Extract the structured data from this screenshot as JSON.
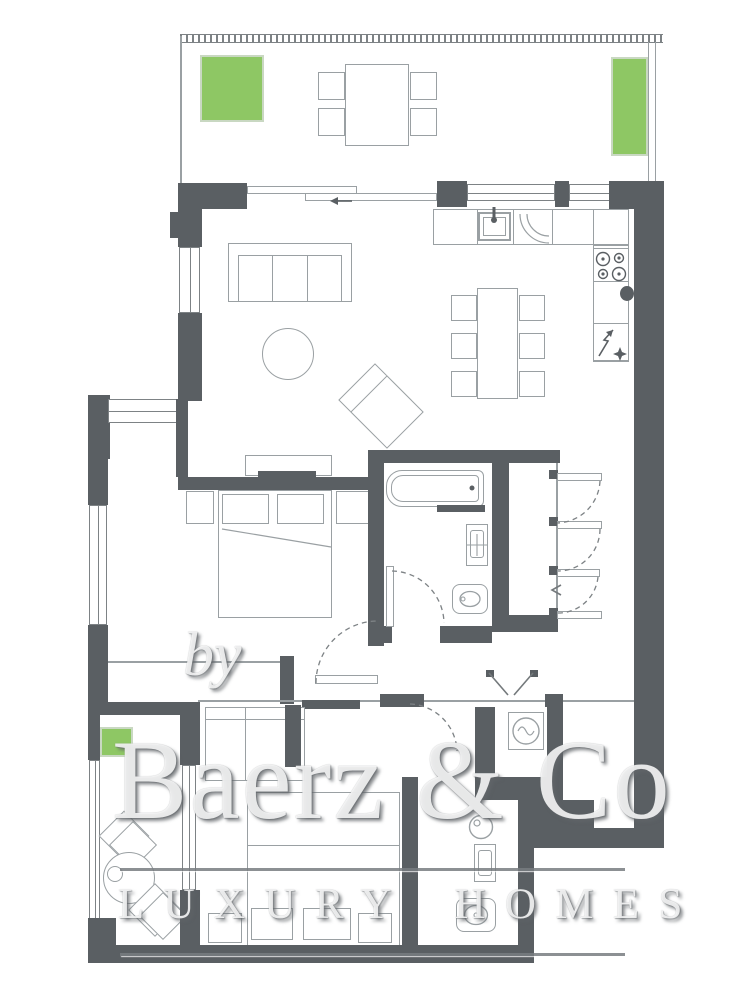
{
  "watermark": {
    "prefix": "by",
    "brand": "Baerz & Co",
    "tagline": "LUXURY HOMES"
  },
  "colors": {
    "wall": "#5a5f63",
    "furniture_line": "#9aa0a3",
    "detail_line": "#7d8285",
    "planter_green": "#8ec764",
    "background": "#ffffff",
    "watermark_text": "#ffffff",
    "watermark_shadow": "#61666a"
  },
  "icons": {
    "stove-icon": "four-burner-cooktop",
    "sink-icon": "basin-with-faucet",
    "power-icon": "lightning-arrow",
    "sparkle-icon": "four-point-star",
    "washing-machine-icon": "drum-with-wave",
    "boiler-icon": "circle-with-dial",
    "door-swing-icon": "dashed-quarter-arc",
    "sliding-door-icon": "offset-panes-with-arrow"
  }
}
